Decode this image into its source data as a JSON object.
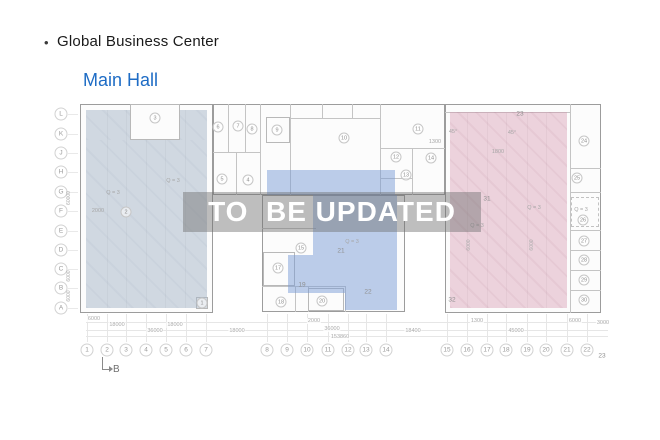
{
  "header": {
    "bullet": "•",
    "title": "Global Business Center",
    "hall_label": "Main Hall"
  },
  "watermark": {
    "text": "TO  BE UPDATED"
  },
  "colors": {
    "hall_blue": "#1e6cc5",
    "zone_left": "#cfd8e0",
    "zone_mid": "#bccfe9",
    "zone_right": "#eed4dd",
    "watermark_band": "#707070",
    "watermark_text": "#ffffff"
  },
  "plan": {
    "row_labels": [
      {
        "label": "L",
        "x": 61,
        "y": 114
      },
      {
        "label": "K",
        "x": 61,
        "y": 134
      },
      {
        "label": "J",
        "x": 61,
        "y": 153
      },
      {
        "label": "H",
        "x": 61,
        "y": 172
      },
      {
        "label": "G",
        "x": 61,
        "y": 192
      },
      {
        "label": "F",
        "x": 61,
        "y": 211
      },
      {
        "label": "E",
        "x": 61,
        "y": 231
      },
      {
        "label": "D",
        "x": 61,
        "y": 250
      },
      {
        "label": "C",
        "x": 61,
        "y": 269
      },
      {
        "label": "B",
        "x": 61,
        "y": 288
      },
      {
        "label": "A",
        "x": 61,
        "y": 308
      }
    ],
    "col_labels": [
      {
        "label": "1",
        "x": 87,
        "y": 350
      },
      {
        "label": "2",
        "x": 107,
        "y": 350
      },
      {
        "label": "3",
        "x": 126,
        "y": 350
      },
      {
        "label": "4",
        "x": 146,
        "y": 350
      },
      {
        "label": "5",
        "x": 166,
        "y": 350
      },
      {
        "label": "6",
        "x": 186,
        "y": 350
      },
      {
        "label": "7",
        "x": 206,
        "y": 350
      },
      {
        "label": "8",
        "x": 267,
        "y": 350
      },
      {
        "label": "9",
        "x": 287,
        "y": 350
      },
      {
        "label": "10",
        "x": 307,
        "y": 350
      },
      {
        "label": "11",
        "x": 328,
        "y": 350
      },
      {
        "label": "12",
        "x": 348,
        "y": 350
      },
      {
        "label": "13",
        "x": 366,
        "y": 350
      },
      {
        "label": "14",
        "x": 386,
        "y": 350
      },
      {
        "label": "15",
        "x": 447,
        "y": 350
      },
      {
        "label": "16",
        "x": 467,
        "y": 350
      },
      {
        "label": "17",
        "x": 487,
        "y": 350
      },
      {
        "label": "18",
        "x": 506,
        "y": 350
      },
      {
        "label": "19",
        "x": 527,
        "y": 350
      },
      {
        "label": "20",
        "x": 546,
        "y": 350
      },
      {
        "label": "21",
        "x": 567,
        "y": 350
      },
      {
        "label": "22",
        "x": 587,
        "y": 350
      },
      {
        "label": "23",
        "x": 602,
        "y": 356,
        "plain": true
      }
    ],
    "rooms": [
      {
        "n": "1",
        "x": 202,
        "y": 303
      },
      {
        "n": "2",
        "x": 126,
        "y": 212
      },
      {
        "n": "3",
        "x": 155,
        "y": 118
      },
      {
        "n": "4",
        "x": 248,
        "y": 180
      },
      {
        "n": "5",
        "x": 222,
        "y": 179
      },
      {
        "n": "6",
        "x": 218,
        "y": 127
      },
      {
        "n": "7",
        "x": 238,
        "y": 126
      },
      {
        "n": "8",
        "x": 252,
        "y": 129
      },
      {
        "n": "9",
        "x": 277,
        "y": 130
      },
      {
        "n": "10",
        "x": 344,
        "y": 138
      },
      {
        "n": "11",
        "x": 418,
        "y": 129
      },
      {
        "n": "12",
        "x": 396,
        "y": 157
      },
      {
        "n": "13",
        "x": 406,
        "y": 175
      },
      {
        "n": "14",
        "x": 431,
        "y": 158
      },
      {
        "n": "15",
        "x": 301,
        "y": 248
      },
      {
        "n": "17",
        "x": 278,
        "y": 268
      },
      {
        "n": "18",
        "x": 281,
        "y": 302
      },
      {
        "n": "19",
        "x": 302,
        "y": 285,
        "plain": true
      },
      {
        "n": "20",
        "x": 322,
        "y": 301
      },
      {
        "n": "21",
        "x": 341,
        "y": 251,
        "plain": true
      },
      {
        "n": "22",
        "x": 368,
        "y": 292,
        "plain": true
      },
      {
        "n": "23",
        "x": 520,
        "y": 114,
        "plain": true
      },
      {
        "n": "24",
        "x": 584,
        "y": 141
      },
      {
        "n": "25",
        "x": 577,
        "y": 178
      },
      {
        "n": "26",
        "x": 583,
        "y": 220
      },
      {
        "n": "27",
        "x": 584,
        "y": 241
      },
      {
        "n": "28",
        "x": 584,
        "y": 260
      },
      {
        "n": "29",
        "x": 584,
        "y": 280
      },
      {
        "n": "30",
        "x": 584,
        "y": 300
      },
      {
        "n": "31",
        "x": 487,
        "y": 199,
        "plain": true
      },
      {
        "n": "32",
        "x": 452,
        "y": 300,
        "plain": true
      }
    ],
    "annotations": [
      {
        "text": "Q = 3",
        "x": 173,
        "y": 181
      },
      {
        "text": "Q = 3",
        "x": 113,
        "y": 193
      },
      {
        "text": "Q = 3",
        "x": 352,
        "y": 242
      },
      {
        "text": "Q = 3",
        "x": 477,
        "y": 226
      },
      {
        "text": "Q = 3",
        "x": 534,
        "y": 208
      },
      {
        "text": "Q = 3",
        "x": 581,
        "y": 210
      },
      {
        "text": "2000",
        "x": 98,
        "y": 211
      },
      {
        "text": "1800",
        "x": 498,
        "y": 152
      },
      {
        "text": "1300",
        "x": 435,
        "y": 142
      },
      {
        "text": "45°",
        "x": 453,
        "y": 132
      },
      {
        "text": "45°",
        "x": 512,
        "y": 133
      }
    ],
    "v_dims": [
      {
        "text": "60000",
        "x": 69,
        "y": 198
      },
      {
        "text": "6000",
        "x": 69,
        "y": 276
      },
      {
        "text": "6000",
        "x": 69,
        "y": 296
      },
      {
        "text": "6000",
        "x": 469,
        "y": 245
      },
      {
        "text": "6000",
        "x": 532,
        "y": 245
      }
    ],
    "h_dims": [
      {
        "text": "6000",
        "x": 94,
        "y": 319
      },
      {
        "text": "18000",
        "x": 117,
        "y": 325
      },
      {
        "text": "18000",
        "x": 175,
        "y": 325
      },
      {
        "text": "36000",
        "x": 155,
        "y": 331
      },
      {
        "text": "18000",
        "x": 237,
        "y": 331
      },
      {
        "text": "2000",
        "x": 314,
        "y": 321
      },
      {
        "text": "36000",
        "x": 332,
        "y": 329
      },
      {
        "text": "1300",
        "x": 477,
        "y": 321
      },
      {
        "text": "6000",
        "x": 575,
        "y": 321
      },
      {
        "text": "3000",
        "x": 603,
        "y": 323
      },
      {
        "text": "18400",
        "x": 413,
        "y": 331
      },
      {
        "text": "45000",
        "x": 516,
        "y": 331
      },
      {
        "text": "153860",
        "x": 340,
        "y": 337
      }
    ],
    "section_marker": {
      "label": "B"
    }
  }
}
